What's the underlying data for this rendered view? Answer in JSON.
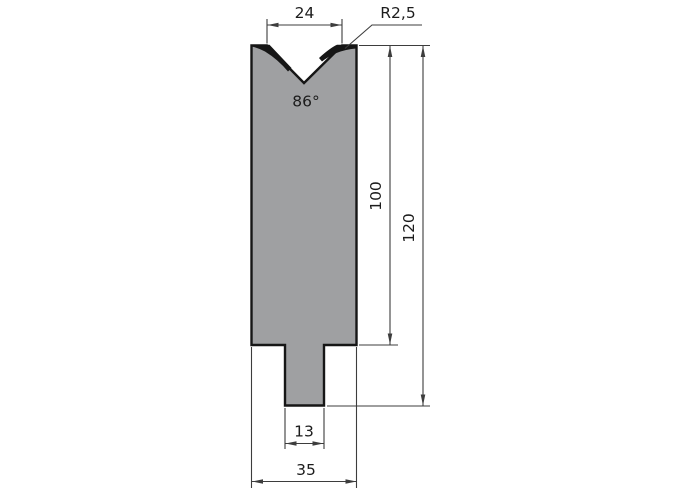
{
  "drawing": {
    "labels": {
      "vee_opening_width": "24",
      "shoulder_radius": "R2,5",
      "vee_angle": "86°",
      "body_height": "100",
      "total_height": "120",
      "tang_width": "13",
      "body_width": "35"
    },
    "colors": {
      "part_fill": "#9fa0a2",
      "outline": "#161616",
      "dimension_line": "#3d3d3d",
      "background": "#ffffff"
    }
  }
}
